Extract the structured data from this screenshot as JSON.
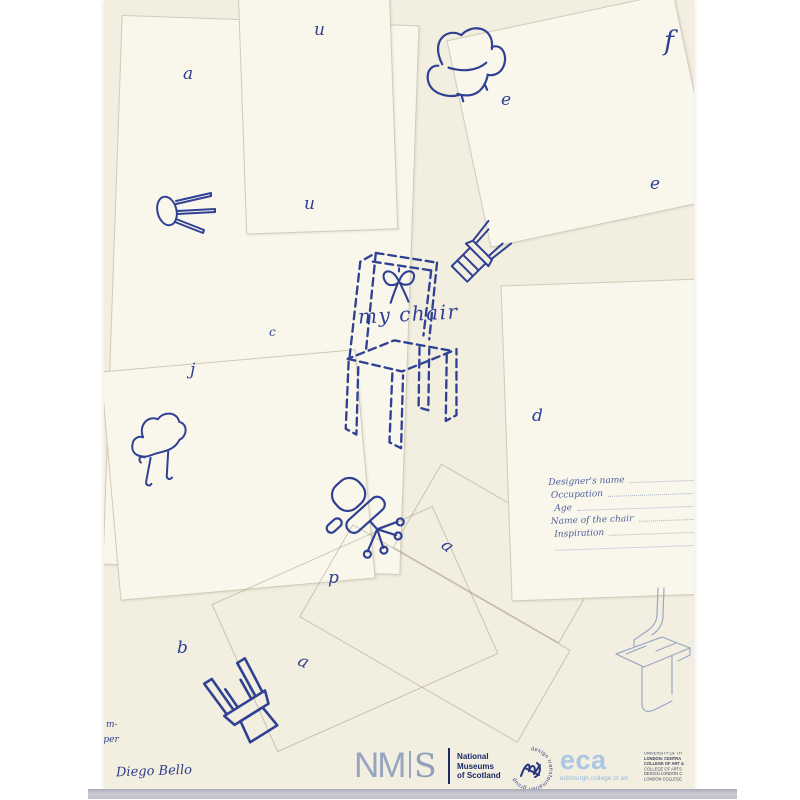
{
  "artwork": {
    "title": "my chair",
    "letters": [
      "a",
      "u",
      "u",
      "e",
      "f",
      "e",
      "c",
      "j",
      "d",
      "p",
      "a",
      "b",
      "a"
    ],
    "fragments": [
      "m-",
      "aper"
    ],
    "signature": "Diego Bello",
    "form": {
      "field_labels": [
        "Designer's name",
        "Occupation",
        "Age",
        "Name of the chair",
        "Inspiration"
      ]
    }
  },
  "footer": {
    "nms_logo": {
      "nm": "NM",
      "s": "S"
    },
    "museum_name_lines": [
      "National",
      "Museums",
      "of Scotland"
    ],
    "dtg_ring_text": "design transformation group",
    "eca": {
      "acronym": "eca",
      "name": "edinburgh college of art"
    },
    "university_lines": [
      "UNIVERSITY OF TH",
      "LONDON: CENTRA",
      "COLLEGE OF ART &",
      "COLLEGE OF ARTS",
      "DESIGN LONDON C",
      "LONDON COLLEGE"
    ]
  },
  "icons": {
    "sketches": [
      "armchair-sketch",
      "stool-sketch",
      "tilted-chair-sketch",
      "dashed-chair-sketch",
      "bow",
      "curvy-chair-sketch",
      "office-chair-sketch",
      "overturned-chair-sketch",
      "cardboard-chair-diagram"
    ]
  },
  "colors": {
    "ink": "#304093",
    "paper": "#f2efe1",
    "card": "#f9f7ec",
    "navy": "#1c2a66",
    "nms_slate": "#96a5bf",
    "eca_blue": "#a9c6e2",
    "stamp_navy": "#2a3780",
    "strip": "#c6c6d1",
    "diagram_line": "#9aa6c4"
  }
}
